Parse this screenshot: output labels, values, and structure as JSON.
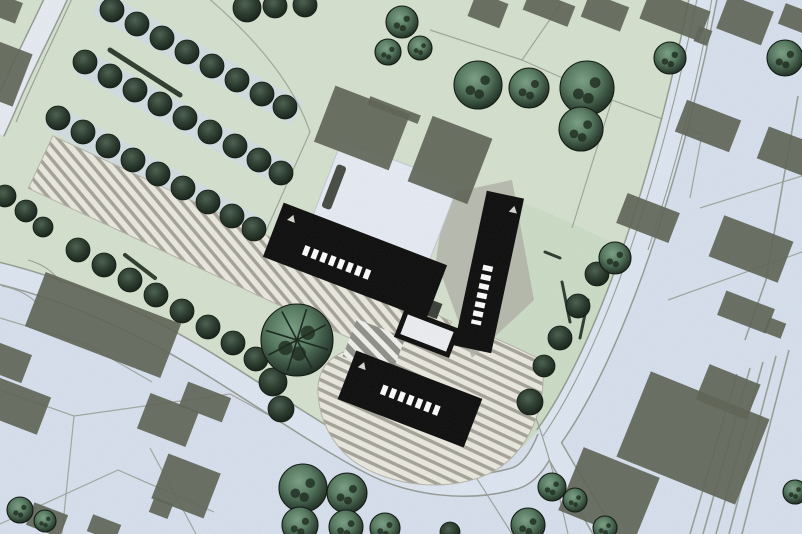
{
  "meta": {
    "kind": "architectural-site-plan",
    "width": 802,
    "height": 534,
    "description": "scanned color site plan: black proposed buildings, gray existing buildings, tree rows, striped parking, curving roads"
  },
  "palette": {
    "road_base": "#d9e2f0",
    "road_fill": "#e0e8f5",
    "road_fill_light": "#e9edf5",
    "road_casing": "#8e958b",
    "green_main": "#d7e3d0",
    "green_wedge": "#c8dcc3",
    "field_tint": "#d3deeb",
    "paving_bg": "#edebe2",
    "paving_stripe": "#a6a499",
    "crosswalk_bg": "#8f9089",
    "crosswalk_stripe": "#f2f3ef",
    "building_existing": "#5d6355",
    "building_new": "#0b0b0b",
    "white_building": "#e9eef7",
    "shadow": "#b1b1a7",
    "parcel_line": "#969d93",
    "hedge": "#2c3a2d",
    "tree_small_core": "#4a5f4e",
    "tree_big_core": "#7aa085",
    "tree_edge": "#101a12",
    "window_strip": "#ffffff",
    "marker": "#d8d8d2"
  },
  "green": {
    "main": [
      [
        0,
        0
      ],
      [
        710,
        0
      ],
      [
        696,
        52
      ],
      [
        670,
        148
      ],
      [
        640,
        242
      ],
      [
        602,
        334
      ],
      [
        560,
        406
      ],
      [
        524,
        446
      ],
      [
        478,
        468
      ],
      [
        424,
        473
      ],
      [
        362,
        456
      ],
      [
        300,
        426
      ],
      [
        228,
        376
      ],
      [
        148,
        330
      ],
      [
        66,
        290
      ],
      [
        0,
        266
      ]
    ],
    "wedge": [
      [
        498,
        192
      ],
      [
        560,
        218
      ],
      [
        630,
        250
      ],
      [
        600,
        330
      ],
      [
        560,
        408
      ],
      [
        524,
        446
      ],
      [
        486,
        462
      ],
      [
        470,
        430
      ],
      [
        488,
        330
      ]
    ],
    "tint_bands": [
      {
        "cx": 198,
        "cy": 58,
        "w": 228,
        "h": 26,
        "rot": 29
      },
      {
        "cx": 183,
        "cy": 118,
        "w": 238,
        "h": 26,
        "rot": 29
      },
      {
        "cx": 156,
        "cy": 174,
        "w": 238,
        "h": 26,
        "rot": 29
      }
    ]
  },
  "roads": {
    "segments": [
      {
        "d": "M 704,-6 C 690,66 668,158 638,246 C 609,332 577,398 548,438",
        "w": 26,
        "fill": "road_fill"
      },
      {
        "d": "M 548,438 C 566,472 588,504 604,534",
        "w": 18,
        "fill": "road_fill"
      },
      {
        "d": "M -6,272 C 70,290 150,326 222,372 C 276,406 330,442 368,462 C 412,486 470,492 516,478 C 530,473 540,458 548,438",
        "w": 20,
        "fill": "road_fill"
      },
      {
        "d": "M 58,-6 C 44,26 22,66 4,110 L -6,132",
        "w": 20,
        "fill": "road_fill_light"
      }
    ],
    "lane_lines": [
      "M 698,-6 C 684,64 662,156 632,244 C 604,328 572,394 543,436",
      "M 712,-2 C 700,70 678,162 648,250",
      "M 74,-6 C 58,30 36,74 16,122",
      "M 470,468 Q 492,502 512,534",
      "M 536,418 Q 552,462 568,534",
      "M 28,260 Q 50,266 62,284",
      "M 2,286 Q 24,290 38,304"
    ]
  },
  "parcel_lines": [
    "M 0,318 L 86,344 L 152,382",
    "M 0,390 L 74,416 L 230,394",
    "M 74,416 L 62,534",
    "M 0,524 L 118,470 L 214,512",
    "M 230,394 L 300,432",
    "M 150,448 L 196,534",
    "M 430,30 L 522,60 L 562,2",
    "M 522,60 L 612,100 L 702,134",
    "M 612,100 L 590,170 L 572,228",
    "M 702,134 L 690,198",
    "M 206,-4 Q 288,66 310,132 L 262,240",
    "M 64,-4 L 20,94",
    "M 668,300 L 802,252",
    "M 700,208 L 802,176"
  ],
  "rails": [
    "M 737,374 L 690,534",
    "M 750,368 L 703,534",
    "M 763,362 L 716,534",
    "M 776,356 L 729,534",
    "M 789,350 L 742,534",
    "M 798,96 L 766,280 L 745,340"
  ],
  "paving": {
    "band": {
      "cx": 240,
      "cy": 255,
      "w": 440,
      "h": 58,
      "rot": 25
    },
    "plaza_path": "M 318,394 C 316,356 348,344 384,348 L 442,330 L 472,328 L 508,344 L 542,360 C 548,408 528,450 496,470 C 454,494 390,488 352,460 C 330,442 320,420 318,394 Z",
    "crosswalk": {
      "cx": 374,
      "cy": 347,
      "w": 52,
      "h": 40,
      "rot": 21
    }
  },
  "shadows": [
    [
      [
        446,
        194
      ],
      [
        512,
        180
      ],
      [
        534,
        300
      ],
      [
        472,
        358
      ],
      [
        436,
        260
      ]
    ],
    [
      [
        310,
        230
      ],
      [
        428,
        266
      ],
      [
        420,
        304
      ],
      [
        298,
        262
      ]
    ]
  ],
  "white_building": {
    "cx": 385,
    "cy": 202,
    "w": 125,
    "h": 85,
    "rot": 21
  },
  "white_dash": {
    "cx": 334,
    "cy": 187,
    "w": 10,
    "h": 46,
    "rot": 21
  },
  "existing_buildings": [
    [
      5,
      8,
      30,
      22,
      21
    ],
    [
      488,
      10,
      34,
      26,
      21
    ],
    [
      549,
      8,
      48,
      22,
      21
    ],
    [
      605,
      12,
      42,
      26,
      21
    ],
    [
      675,
      15,
      64,
      32,
      21
    ],
    [
      745,
      20,
      48,
      36,
      21
    ],
    [
      703,
      36,
      14,
      16,
      21
    ],
    [
      794,
      18,
      26,
      22,
      21
    ],
    [
      3,
      73,
      42,
      56,
      21
    ],
    [
      362,
      128,
      80,
      60,
      21
    ],
    [
      450,
      160,
      64,
      70,
      21
    ],
    [
      394,
      110,
      54,
      9,
      21
    ],
    [
      103,
      325,
      145,
      58,
      21
    ],
    [
      648,
      218,
      56,
      32,
      21
    ],
    [
      708,
      126,
      58,
      34,
      21
    ],
    [
      788,
      152,
      54,
      34,
      21
    ],
    [
      751,
      249,
      74,
      44,
      21
    ],
    [
      746,
      312,
      52,
      26,
      21
    ],
    [
      775,
      328,
      18,
      16,
      21
    ],
    [
      693,
      438,
      128,
      92,
      22
    ],
    [
      728,
      392,
      55,
      38,
      22
    ],
    [
      609,
      494,
      82,
      68,
      22
    ],
    [
      15,
      405,
      62,
      40,
      21
    ],
    [
      168,
      420,
      52,
      38,
      21
    ],
    [
      205,
      402,
      46,
      26,
      21
    ],
    [
      186,
      486,
      56,
      48,
      21
    ],
    [
      161,
      508,
      20,
      16,
      21
    ],
    [
      47,
      520,
      36,
      24,
      21
    ],
    [
      104,
      528,
      30,
      18,
      21
    ],
    [
      8,
      362,
      40,
      30,
      21
    ]
  ],
  "new_buildings": [
    {
      "id": "bar-a",
      "cx": 355,
      "cy": 261,
      "w": 175,
      "h": 58,
      "rot": 21,
      "strip": [
        -52,
        8,
        22,
        8
      ],
      "marker": [
        -74,
        -17
      ]
    },
    {
      "id": "bar-b",
      "cx": 489,
      "cy": 272,
      "w": 38,
      "h": 158,
      "rot": 12,
      "strip": [
        -2,
        -6,
        -2,
        54
      ],
      "marker": [
        11,
        -66
      ]
    },
    {
      "id": "bar-c",
      "cx": 410,
      "cy": 399,
      "w": 135,
      "h": 52,
      "rot": 21,
      "strip": [
        -30,
        1,
        32,
        1
      ],
      "marker": [
        -56,
        -14
      ]
    }
  ],
  "pavilion_block": {
    "cx": 420,
    "cy": 304,
    "w": 42,
    "h": 16,
    "rot": 21
  },
  "pavilion": {
    "cx": 427,
    "cy": 333,
    "w": 54,
    "h": 26,
    "rot": 21
  },
  "hedges": [
    [
      110,
      50,
      180,
      95,
      5
    ],
    [
      125,
      255,
      155,
      278,
      4
    ],
    [
      562,
      282,
      570,
      322,
      3
    ],
    [
      588,
      300,
      580,
      338,
      3
    ],
    [
      545,
      252,
      560,
      258,
      3
    ]
  ],
  "trees": [
    [
      112,
      10,
      12,
      0
    ],
    [
      137,
      24,
      12,
      0
    ],
    [
      162,
      38,
      12,
      0
    ],
    [
      187,
      52,
      12,
      0
    ],
    [
      212,
      66,
      12,
      0
    ],
    [
      237,
      80,
      12,
      0
    ],
    [
      262,
      94,
      12,
      0
    ],
    [
      285,
      107,
      12,
      0
    ],
    [
      85,
      62,
      12,
      0
    ],
    [
      110,
      76,
      12,
      0
    ],
    [
      135,
      90,
      12,
      0
    ],
    [
      160,
      104,
      12,
      0
    ],
    [
      185,
      118,
      12,
      0
    ],
    [
      210,
      132,
      12,
      0
    ],
    [
      235,
      146,
      12,
      0
    ],
    [
      259,
      160,
      12,
      0
    ],
    [
      281,
      173,
      12,
      0
    ],
    [
      58,
      118,
      12,
      0
    ],
    [
      83,
      132,
      12,
      0
    ],
    [
      108,
      146,
      12,
      0
    ],
    [
      133,
      160,
      12,
      0
    ],
    [
      158,
      174,
      12,
      0
    ],
    [
      183,
      188,
      12,
      0
    ],
    [
      208,
      202,
      12,
      0
    ],
    [
      232,
      216,
      12,
      0
    ],
    [
      254,
      229,
      12,
      0
    ],
    [
      78,
      250,
      12,
      0
    ],
    [
      104,
      265,
      12,
      0
    ],
    [
      130,
      280,
      12,
      0
    ],
    [
      156,
      295,
      12,
      0
    ],
    [
      182,
      311,
      12,
      0
    ],
    [
      208,
      327,
      12,
      0
    ],
    [
      233,
      343,
      12,
      0
    ],
    [
      256,
      359,
      12,
      0
    ],
    [
      273,
      382,
      14,
      0
    ],
    [
      281,
      409,
      13,
      0
    ],
    [
      5,
      196,
      11,
      0
    ],
    [
      26,
      211,
      11,
      0
    ],
    [
      43,
      227,
      10,
      0
    ],
    [
      597,
      274,
      12,
      0
    ],
    [
      578,
      306,
      12,
      0
    ],
    [
      560,
      338,
      12,
      0
    ],
    [
      544,
      366,
      11,
      0
    ],
    [
      530,
      402,
      13,
      0
    ],
    [
      247,
      8,
      14,
      0
    ],
    [
      275,
      6,
      12,
      0
    ],
    [
      305,
      5,
      12,
      0
    ],
    [
      402,
      22,
      16,
      1
    ],
    [
      388,
      52,
      13,
      1
    ],
    [
      420,
      48,
      12,
      1
    ],
    [
      478,
      85,
      24,
      1
    ],
    [
      529,
      88,
      20,
      1
    ],
    [
      587,
      88,
      27,
      1
    ],
    [
      581,
      129,
      22,
      1
    ],
    [
      670,
      58,
      16,
      1
    ],
    [
      785,
      58,
      18,
      1
    ],
    [
      615,
      258,
      16,
      1
    ],
    [
      297,
      340,
      36,
      2
    ],
    [
      303,
      488,
      24,
      1
    ],
    [
      347,
      493,
      20,
      1
    ],
    [
      300,
      525,
      18,
      1
    ],
    [
      346,
      527,
      17,
      1
    ],
    [
      385,
      528,
      15,
      1
    ],
    [
      450,
      532,
      10,
      0
    ],
    [
      528,
      525,
      17,
      1
    ],
    [
      552,
      487,
      14,
      1
    ],
    [
      575,
      500,
      12,
      1
    ],
    [
      605,
      528,
      12,
      1
    ],
    [
      20,
      510,
      13,
      1
    ],
    [
      45,
      521,
      11,
      1
    ],
    [
      795,
      492,
      12,
      1
    ]
  ]
}
